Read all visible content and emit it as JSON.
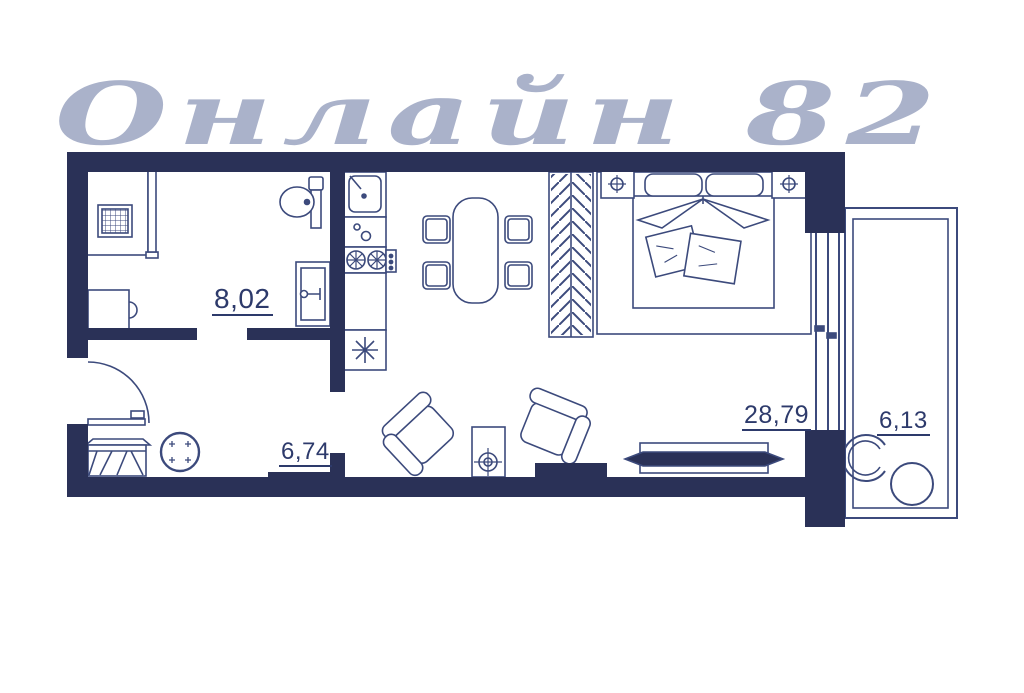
{
  "watermark": {
    "text": "Онлайн 82"
  },
  "plan": {
    "type": "apartment-floor-plan",
    "rooms": [
      {
        "name": "bathroom",
        "area": "8,02"
      },
      {
        "name": "hallway",
        "area": "6,74"
      },
      {
        "name": "living-kitchen",
        "area": "28,79"
      },
      {
        "name": "balcony",
        "area": "6,13"
      }
    ],
    "furniture_icons": [
      "shower-cabin",
      "toilet",
      "washbasin-vanity",
      "washing-machine",
      "kitchen-sink",
      "kitchen-counter",
      "stove",
      "refrigerator",
      "dining-table",
      "dining-chair",
      "wardrobe",
      "double-bed",
      "nightstand",
      "bed-lamp",
      "decor-pillow",
      "armchair",
      "floor-lamp",
      "tv",
      "tv-stand",
      "entrance-door",
      "shoe-bench",
      "round-stool",
      "balcony-chair",
      "balcony-table",
      "window"
    ]
  },
  "colors": {
    "wall": "#2a3157",
    "furniture_line": "#3c4a7c",
    "label": "#2d3a6b",
    "watermark": "#98a2bf",
    "background": "#ffffff"
  }
}
